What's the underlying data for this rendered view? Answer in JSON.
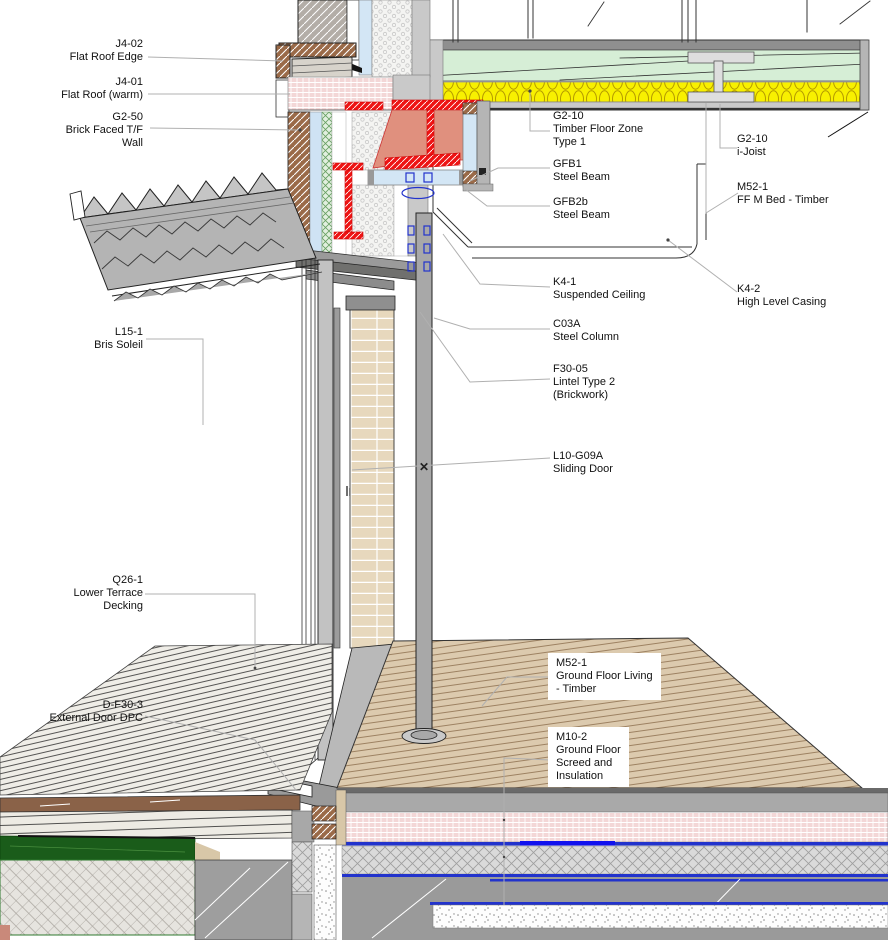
{
  "drawing_title": "Wall / Floor Junction Detail",
  "labels": {
    "left": [
      {
        "code": "J4-02",
        "lines": [
          "Flat Roof Edge"
        ]
      },
      {
        "code": "J4-01",
        "lines": [
          "Flat Roof (warm)"
        ]
      },
      {
        "code": "G2-50",
        "lines": [
          "Brick Faced T/F",
          "Wall"
        ]
      },
      {
        "code": "L15-1",
        "lines": [
          "Bris Soleil"
        ]
      },
      {
        "code": "Q26-1",
        "lines": [
          "Lower Terrace",
          "Decking"
        ]
      },
      {
        "code": "D-F30-3",
        "lines": [
          "External Door DPC"
        ]
      }
    ],
    "middle": [
      {
        "code": "G2-10",
        "lines": [
          "Timber Floor Zone",
          "Type 1"
        ]
      },
      {
        "code": "GFB1",
        "lines": [
          "Steel Beam"
        ]
      },
      {
        "code": "GFB2b",
        "lines": [
          "Steel Beam"
        ]
      },
      {
        "code": "K4-1",
        "lines": [
          "Suspended Ceiling"
        ]
      },
      {
        "code": "C03A",
        "lines": [
          "Steel Column"
        ]
      },
      {
        "code": "F30-05",
        "lines": [
          "Lintel Type 2",
          "(Brickwork)"
        ]
      },
      {
        "code": "L10-G09A",
        "lines": [
          "Sliding Door"
        ]
      },
      {
        "code": "M52-1",
        "lines": [
          "Ground Floor Living",
          "- Timber"
        ]
      },
      {
        "code": "M10-2",
        "lines": [
          "Ground Floor",
          "Screed and",
          "Insulation"
        ]
      }
    ],
    "right": [
      {
        "code": "G2-10",
        "lines": [
          "i-Joist"
        ]
      },
      {
        "code": "M52-1",
        "lines": [
          "FF M Bed - Timber"
        ]
      },
      {
        "code": "K4-2",
        "lines": [
          "High Level Casing"
        ]
      }
    ]
  },
  "glyphs": {
    "position_marker": "✕"
  },
  "colors": {
    "steel_red": "#ee1313",
    "beam_web_salmon": "#e0907e",
    "insulation_yellow": "#f8f000",
    "floor_zone_green": "#d6eed6",
    "insulation_pink": "#f3d7d7",
    "dpm_blue": "#2233cc",
    "grass_green": "#1a5c1a",
    "timber_floor_tan": "#dccaae",
    "brick_brown": "#9a6a48",
    "fitting_blue": "#2233cc",
    "leader_gray": "#b0b0b0"
  }
}
